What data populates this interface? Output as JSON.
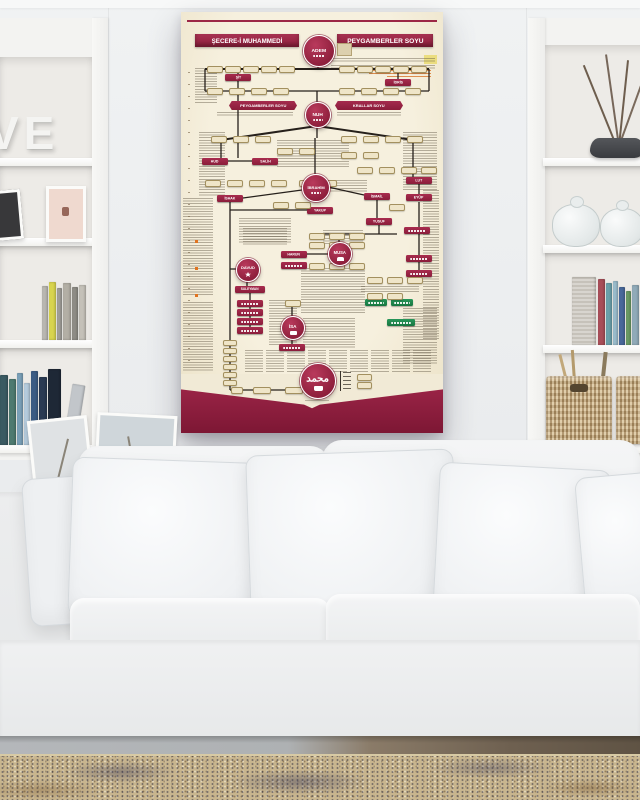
{
  "poster": {
    "header": {
      "left_title": "ŞECERE-İ MUHAMMEDİ",
      "right_title": "PEYGAMBERLER SOYU"
    },
    "banners": {
      "left": "PEYGAMBERLER SOYU",
      "right": "KRALLAR SOYU"
    },
    "circles": {
      "adem": "ADEM",
      "nuh": "NUH",
      "ibrahim": "İBRAHİM",
      "musa": "MUSA",
      "davud": "DAVUD",
      "isa": "İSA",
      "muhammed": "محمد"
    },
    "nodes": {
      "sit": "ŞİT",
      "idris": "İDRİS",
      "hud": "HUD",
      "salih": "SALİH",
      "ishak": "İSHAK",
      "ismail": "İSMAİL",
      "lut": "LUT",
      "yakup": "YAKUP",
      "yusuf": "YUSUF",
      "eyup": "EYÜP",
      "harun": "HARUN",
      "suleyman": "SÜLEYMAN"
    },
    "colors": {
      "maroon": "#9c2746",
      "footer_maroon": "#8b1e3c",
      "cream": "#f1ead6",
      "green": "#1f8a4e",
      "accent_orange": "#e0731f"
    }
  },
  "decor": {
    "shelf_letters": "VE"
  }
}
